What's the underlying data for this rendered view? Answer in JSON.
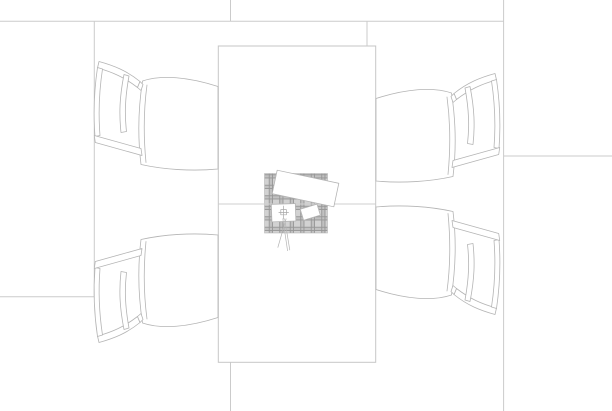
{
  "scene": {
    "view": "top-down plan drawing",
    "objects": [
      {
        "id": "table",
        "label": "rectangular dining table with center seam"
      },
      {
        "id": "chair-top-left",
        "label": "upholstered chair with seat cushion"
      },
      {
        "id": "chair-bottom-left",
        "label": "upholstered chair with seat cushion"
      },
      {
        "id": "chair-top-right",
        "label": "upholstered chair with seat cushion"
      },
      {
        "id": "chair-bottom-right",
        "label": "upholstered chair with seat cushion"
      },
      {
        "id": "tartan-blanket",
        "label": "plaid blanket centerpiece"
      },
      {
        "id": "napkin",
        "label": "rotated white napkin"
      },
      {
        "id": "card",
        "label": "small tilted white card"
      },
      {
        "id": "gift-box",
        "label": "white box with ribbon knot and two tails"
      }
    ],
    "chair_count": 4
  },
  "colors": {
    "canvas_bg": "#ffffff",
    "floor_line": "#cbcbcb",
    "table_stroke": "#c6c6c6",
    "table_fill": "#ffffff",
    "seam_line": "#cfcfcf",
    "chair_stroke": "#b4b4b4",
    "chair_fill": "#ffffff",
    "item_stroke": "#b4b4b4",
    "item_fill": "#ffffff",
    "plaid_base": "#d2d2d2",
    "plaid_band": "#c1c1c1",
    "plaid_dark": "#979797",
    "plaid_border": "#b8b8b8",
    "detail_stroke": "#a8a8a8"
  }
}
